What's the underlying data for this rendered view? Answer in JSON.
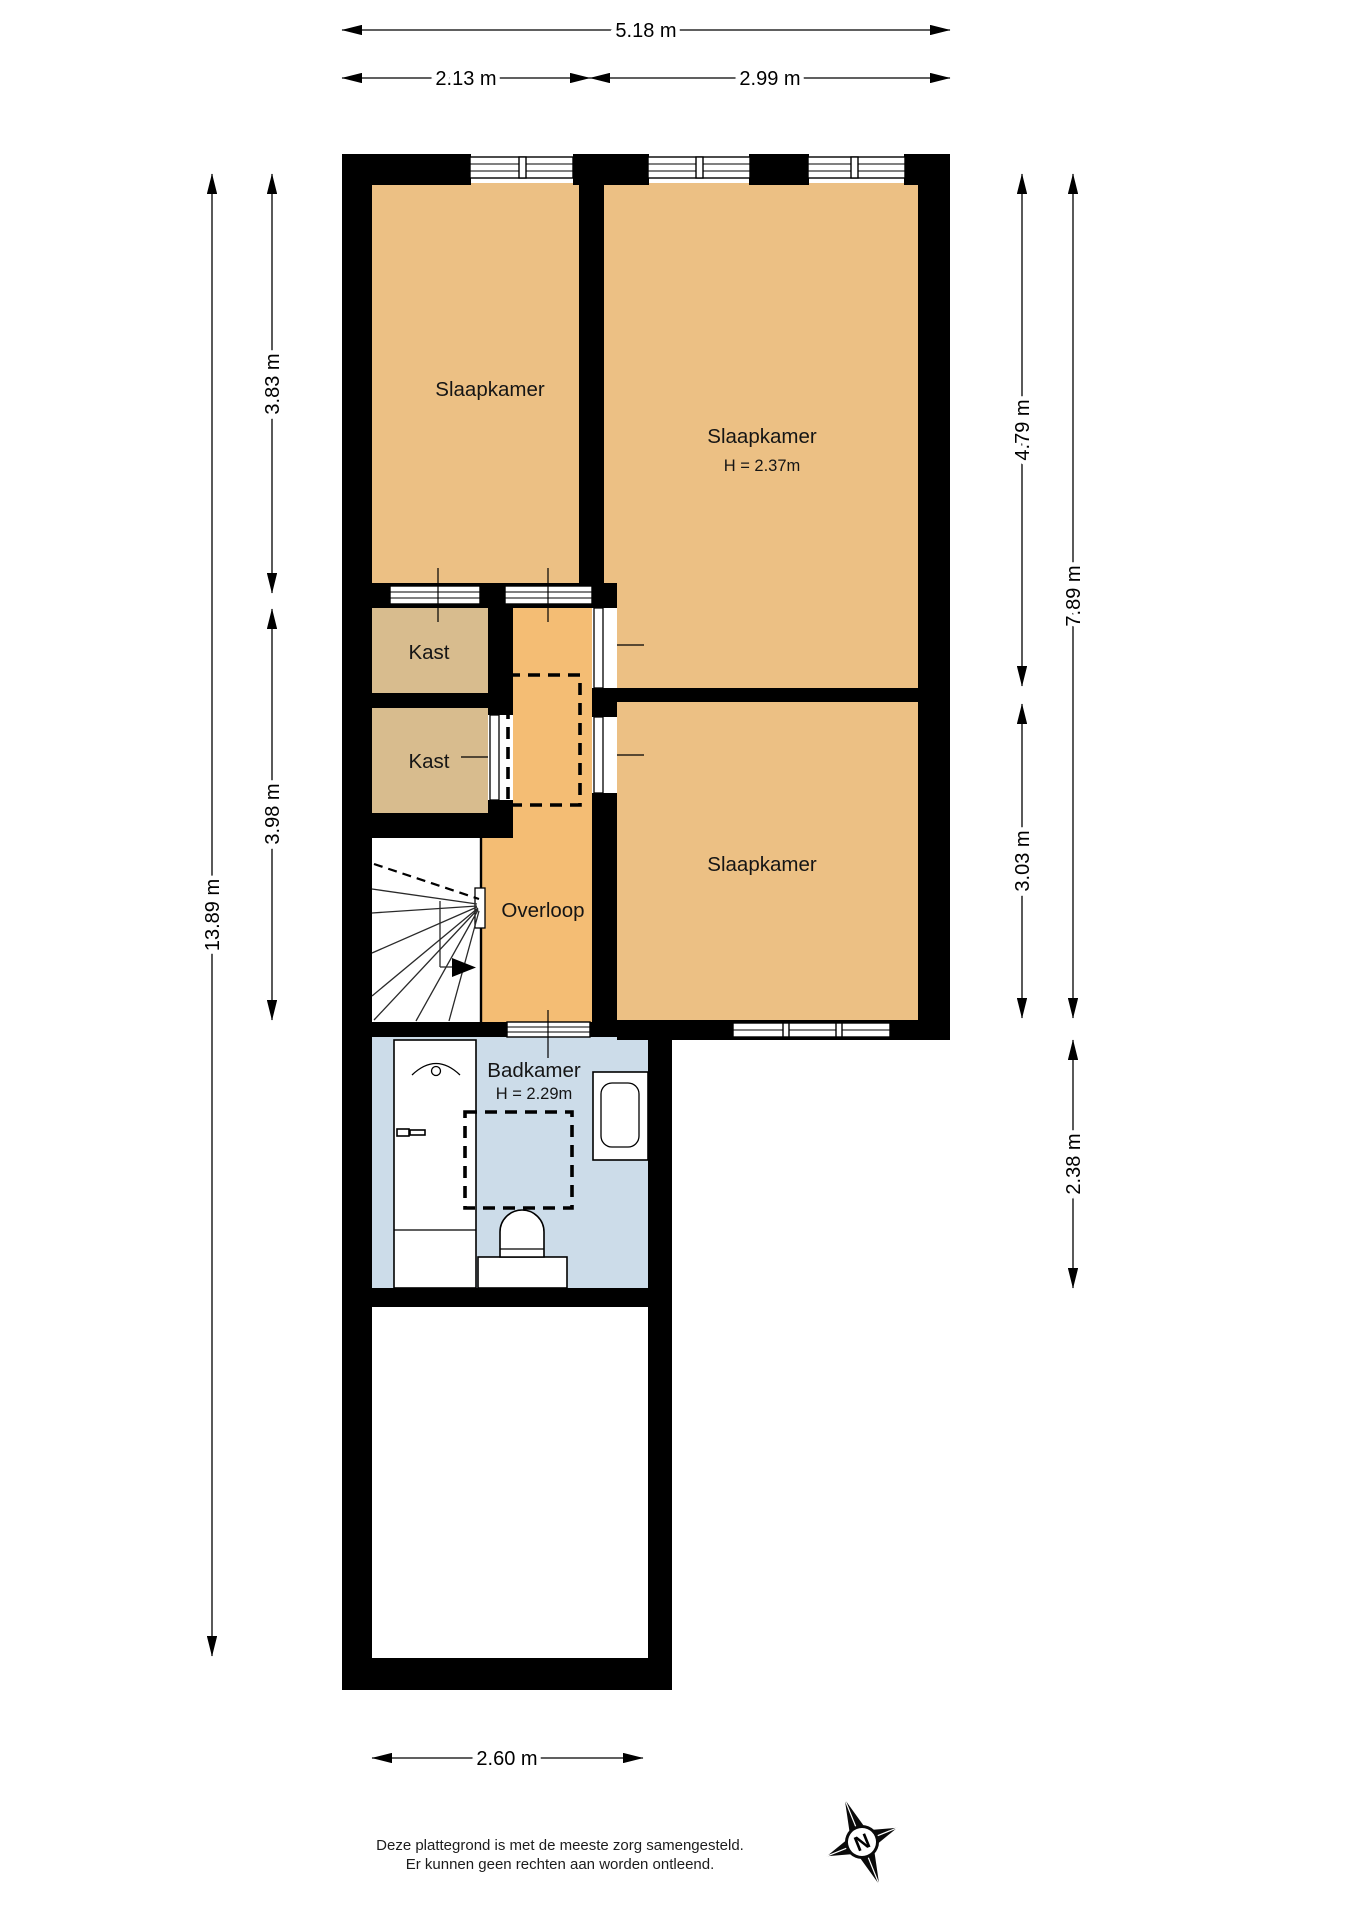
{
  "rooms": {
    "bedroom_top_left": {
      "label": "Slaapkamer"
    },
    "bedroom_top_right": {
      "label": "Slaapkamer",
      "ceiling_height": "H = 2.37m"
    },
    "bedroom_middle": {
      "label": "Slaapkamer"
    },
    "closet_upper": {
      "label": "Kast"
    },
    "closet_lower": {
      "label": "Kast"
    },
    "landing": {
      "label": "Overloop"
    },
    "bathroom": {
      "label": "Badkamer",
      "ceiling_height": "H = 2.29m"
    }
  },
  "dimensions": {
    "top_total": "5.18 m",
    "top_left": "2.13 m",
    "top_right": "2.99 m",
    "left_upper": "3.83 m",
    "left_lower": "3.98 m",
    "left_total": "13.89 m",
    "right_upper": "4.79 m",
    "right_lower": "3.03 m",
    "right_total": "7.89 m",
    "right_bathroom": "2.38 m",
    "bottom": "2.60 m"
  },
  "compass": {
    "north_label": "N"
  },
  "footer": {
    "line1": "Deze plattegrond is met de meeste zorg samengesteld.",
    "line2": "Er kunnen geen rechten aan worden ontleend."
  },
  "colors": {
    "room_fill": "#ecc084",
    "closet_fill": "#d8bc8e",
    "landing_fill": "#f4bd74",
    "bathroom_fill": "#ccdce9",
    "wall": "#000000"
  }
}
